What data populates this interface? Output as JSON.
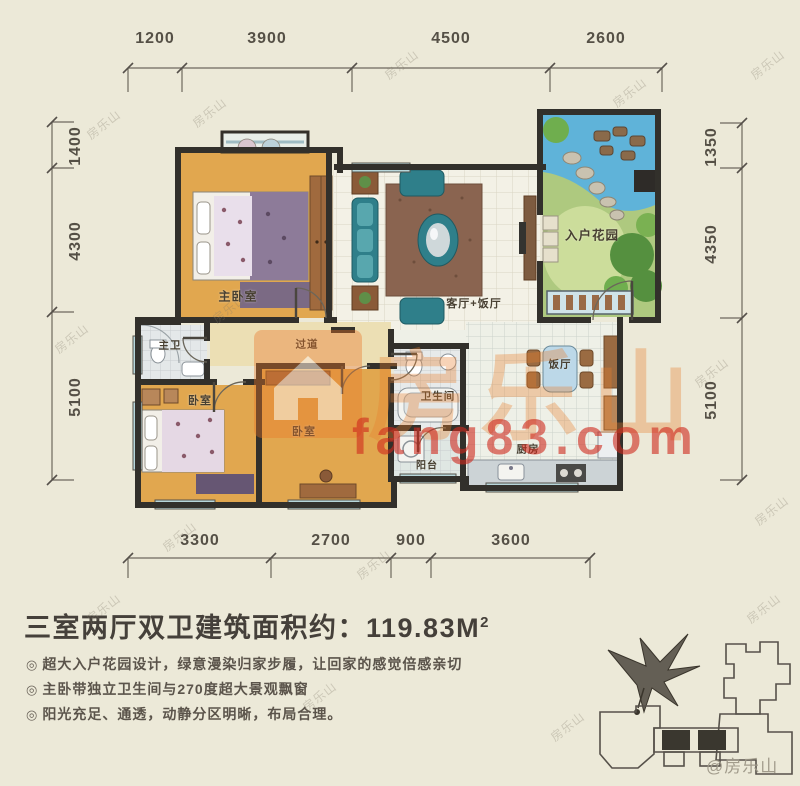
{
  "dimensions": {
    "top": [
      "1200",
      "3900",
      "4500",
      "2600"
    ],
    "left": [
      "1400",
      "4300",
      "5100"
    ],
    "right": [
      "1350",
      "4350",
      "5100"
    ],
    "bottom": [
      "3300",
      "2700",
      "900",
      "3600"
    ]
  },
  "rooms": {
    "master_bedroom": "主卧室",
    "master_bath": "主卫",
    "hallway": "过道",
    "bedroom_left": "卧室",
    "bedroom_mid": "卧室",
    "bathroom": "卫生间",
    "balcony": "阳台",
    "kitchen": "厨房",
    "dining": "饭厅",
    "living_dining": "客厅+饭厅",
    "entry_garden": "入户花园"
  },
  "watermark": {
    "brand": "房乐山",
    "site": "fang83.com",
    "credit": "@房乐山"
  },
  "summary": {
    "title_text": "三室两厅双卫建筑面积约：119.83",
    "title_unit": "M",
    "title_sup": "2",
    "bullet_icon": "◎",
    "bullets": [
      "超大入户花园设计，绿意漫染归家步履，让回家的感觉倍感亲切",
      "主卧带独立卫生间与270度超大景观飘窗",
      "阳光充足、通透，动静分区明晰，布局合理。"
    ]
  }
}
